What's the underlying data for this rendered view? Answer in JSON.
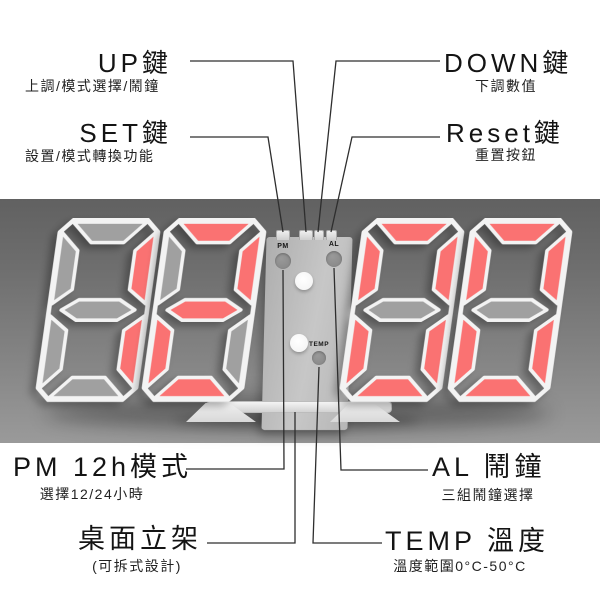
{
  "clock": {
    "time_shown": "12:00",
    "digits": [
      "1",
      "2",
      "0",
      "0"
    ],
    "panel": {
      "pm_label": "PM",
      "al_label": "AL",
      "temp_label": "TEMP"
    },
    "colors": {
      "lit_segment": "#fa7272",
      "unlit_segment": "#a0a0a0",
      "frame": "#f3f3f3",
      "band_top": "#616161",
      "band_bottom": "#9a9a9a",
      "panel_bg": "#bdbdbd"
    }
  },
  "callouts": {
    "up": {
      "title": "UP鍵",
      "subtitle": "上調/模式選擇/鬧鐘"
    },
    "set": {
      "title": "SET鍵",
      "subtitle": "設置/模式轉換功能"
    },
    "down": {
      "title": "DOWN鍵",
      "subtitle": "下調數值"
    },
    "reset": {
      "title": "Reset鍵",
      "subtitle": "重置按鈕"
    },
    "pm": {
      "title": "PM 12h模式",
      "subtitle": "選擇12/24小時"
    },
    "al": {
      "title": "AL 鬧鐘",
      "subtitle": "三組鬧鐘選擇"
    },
    "stand": {
      "title": "桌面立架",
      "subtitle": "(可拆式設計)"
    },
    "temp": {
      "title": "TEMP 溫度",
      "subtitle": "溫度範圍0°C-50°C"
    }
  }
}
